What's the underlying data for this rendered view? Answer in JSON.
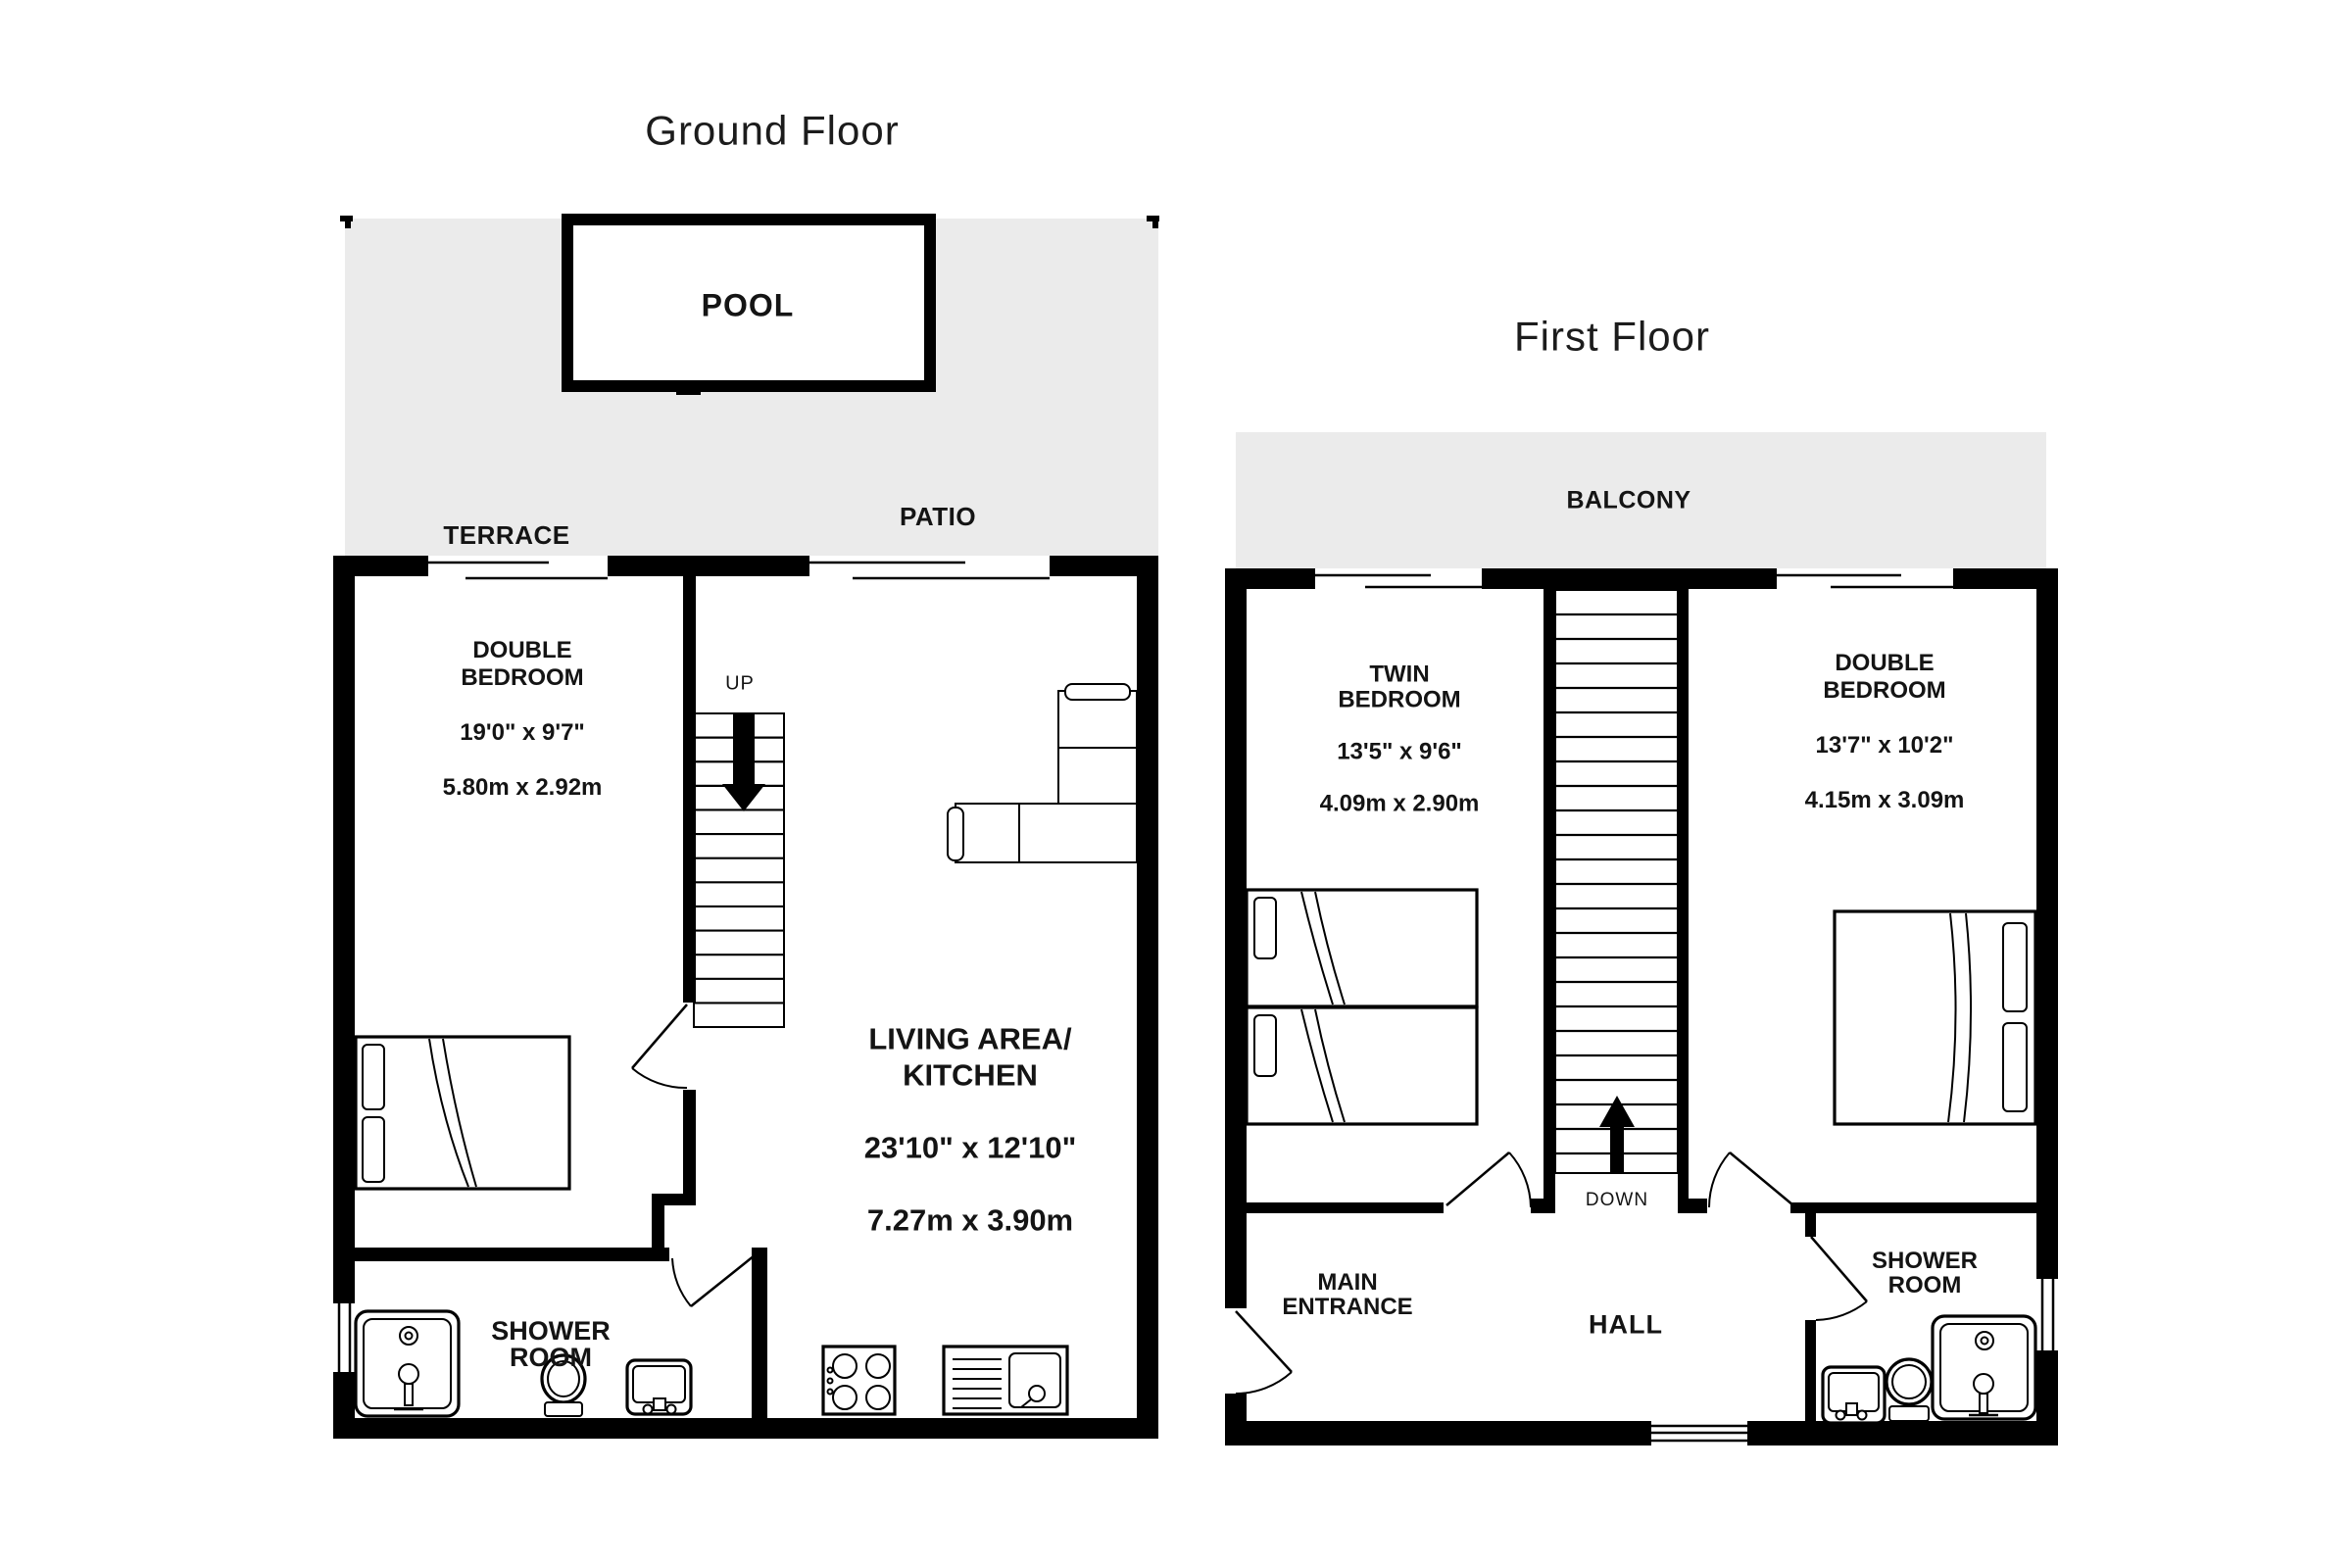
{
  "ground_floor": {
    "title": "Ground Floor",
    "pool_label": "POOL",
    "terrace_label": "TERRACE",
    "patio_label": "PATIO",
    "up_label": "UP",
    "shower_room_label": "SHOWER\nROOM",
    "double_bedroom": {
      "name": "DOUBLE\nBEDROOM",
      "dims_imperial": "19'0\"  x 9'7\"",
      "dims_metric": "5.80m  x 2.92m"
    },
    "living_area": {
      "name": "LIVING AREA/\nKITCHEN",
      "dims_imperial": "23'10\"  x 12'10\"",
      "dims_metric": "7.27m  x 3.90m"
    }
  },
  "first_floor": {
    "title": "First Floor",
    "balcony_label": "BALCONY",
    "down_label": "DOWN",
    "hall_label": "HALL",
    "main_entrance_label": "MAIN\nENTRANCE",
    "shower_room_label": "SHOWER\nROOM",
    "twin_bedroom": {
      "name": "TWIN\nBEDROOM",
      "dims_imperial": "13'5\"  x 9'6\"",
      "dims_metric": "4.09m  x 2.90m"
    },
    "double_bedroom": {
      "name": "DOUBLE\nBEDROOM",
      "dims_imperial": "13'7\"  x 10'2\"",
      "dims_metric": "4.15m  x 3.09m"
    }
  },
  "colors": {
    "wall": "#000000",
    "outdoor_fill": "#ebebeb",
    "text": "#141414"
  }
}
